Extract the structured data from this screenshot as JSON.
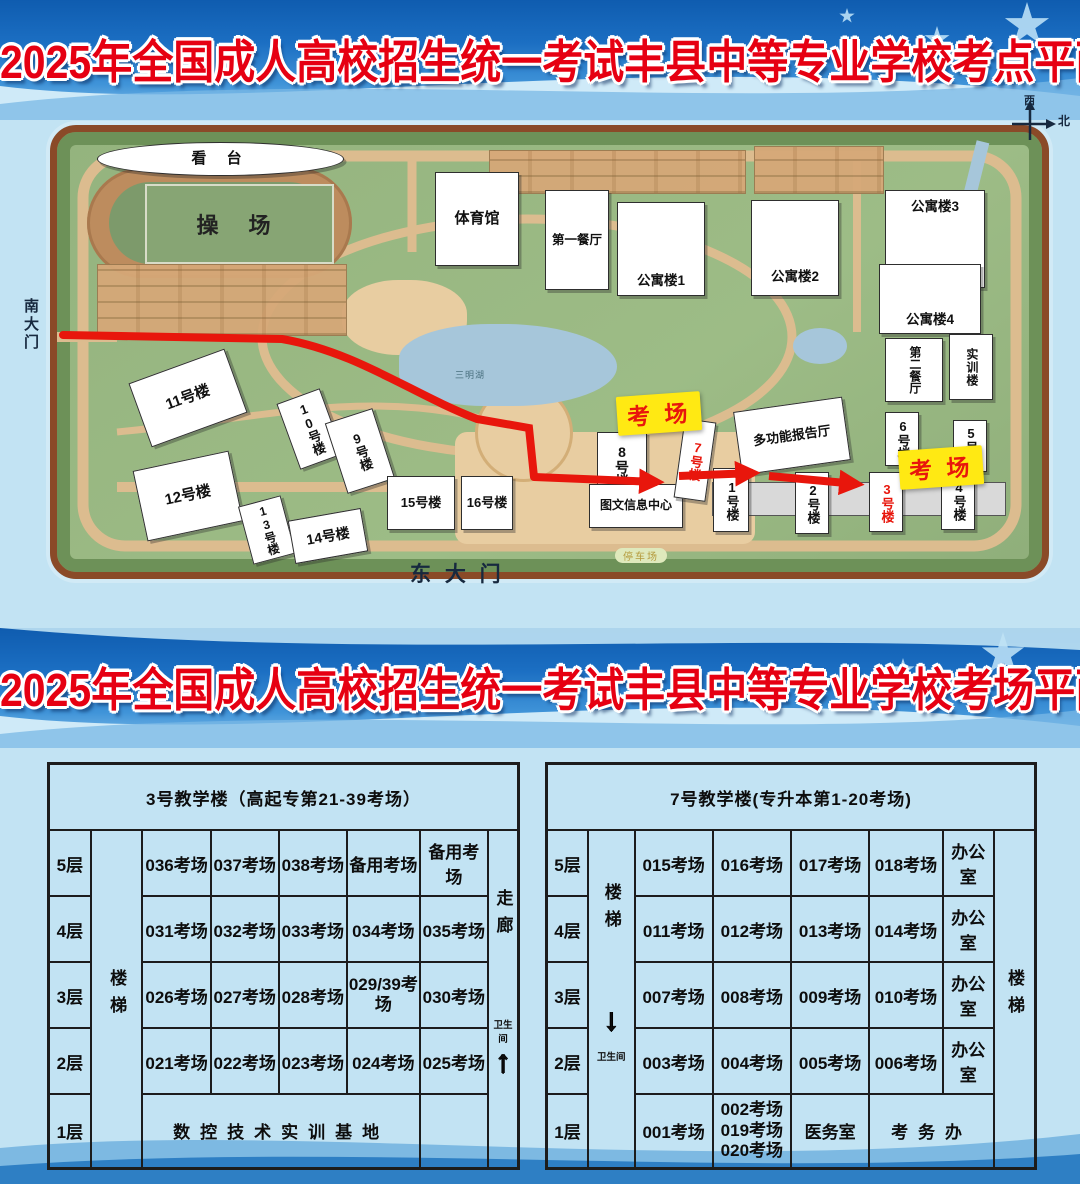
{
  "titles": {
    "top": "2025年全国成人高校招生统一考试丰县中等专业学校考点平面图",
    "bottom": "2025年全国成人高校招生统一考试丰县中等专业学校考场平面图"
  },
  "map": {
    "compass": {
      "west": "西",
      "north": "北"
    },
    "south_gate": "南大门",
    "east_gate": "东 大 门",
    "lake": "三明湖",
    "parking": "停车场",
    "exam_badge": "考 场",
    "buildings": {
      "grandstand": "看 台",
      "playground": "操 场",
      "gym": "体育馆",
      "dining1": "第一餐厅",
      "apt1": "公寓楼1",
      "apt2": "公寓楼2",
      "apt3": "公寓楼3",
      "apt4": "公寓楼4",
      "dining2": "第二餐厅",
      "training": "实训楼",
      "report_hall": "多功能报告厅",
      "library": "图文信息中心",
      "no1": "1号楼",
      "no2": "2号楼",
      "no3": "3号楼",
      "no4": "4号楼",
      "no5": "5号楼",
      "no6": "6号楼",
      "no7": "7号楼",
      "no8": "8号楼",
      "no9": "9号楼",
      "no10": "10号楼",
      "no11": "11号楼",
      "no12": "12号楼",
      "no13": "13号楼",
      "no14": "14号楼",
      "no15": "15号楼",
      "no16": "16号楼"
    }
  },
  "icons": {
    "up_arrow": "↑",
    "down_arrow": "↓"
  },
  "tables": {
    "left": {
      "title": "3号教学楼（高起专第21-39考场）",
      "stairs": "楼梯",
      "corridor": "走廊",
      "toilet": "卫生间",
      "floors": [
        "5层",
        "4层",
        "3层",
        "2层",
        "1层"
      ],
      "rows": [
        [
          "036考场",
          "037考场",
          "038考场",
          "备用考场",
          "备用考场"
        ],
        [
          "031考场",
          "032考场",
          "033考场",
          "034考场",
          "035考场"
        ],
        [
          "026考场",
          "027考场",
          "028考场",
          "029/39考场",
          "030考场"
        ],
        [
          "021考场",
          "022考场",
          "023考场",
          "024考场",
          "025考场"
        ]
      ],
      "floor1": "数控技术实训基地"
    },
    "right": {
      "title": "7号教学楼(专升本第1-20考场)",
      "stairs_left": "楼梯",
      "stairs_right": "楼梯",
      "toilet": "卫生间",
      "floors": [
        "5层",
        "4层",
        "3层",
        "2层",
        "1层"
      ],
      "rows": [
        [
          "015考场",
          "016考场",
          "017考场",
          "018考场",
          "办公室"
        ],
        [
          "011考场",
          "012考场",
          "013考场",
          "014考场",
          "办公室"
        ],
        [
          "007考场",
          "008考场",
          "009考场",
          "010考场",
          "办公室"
        ],
        [
          "003考场",
          "004考场",
          "005考场",
          "006考场",
          "办公室"
        ]
      ],
      "floor1": {
        "c1": "001考场",
        "c2_lines": [
          "002考场",
          "019考场",
          "020考场"
        ],
        "c3": "医务室",
        "c4": "考务办"
      }
    }
  },
  "colors": {
    "title_red": "#e60012",
    "route_red": "#e8160c",
    "badge_yellow": "#ffe913",
    "banner_blue": "#1b6ec2",
    "table_text": "#0d0d0d"
  }
}
